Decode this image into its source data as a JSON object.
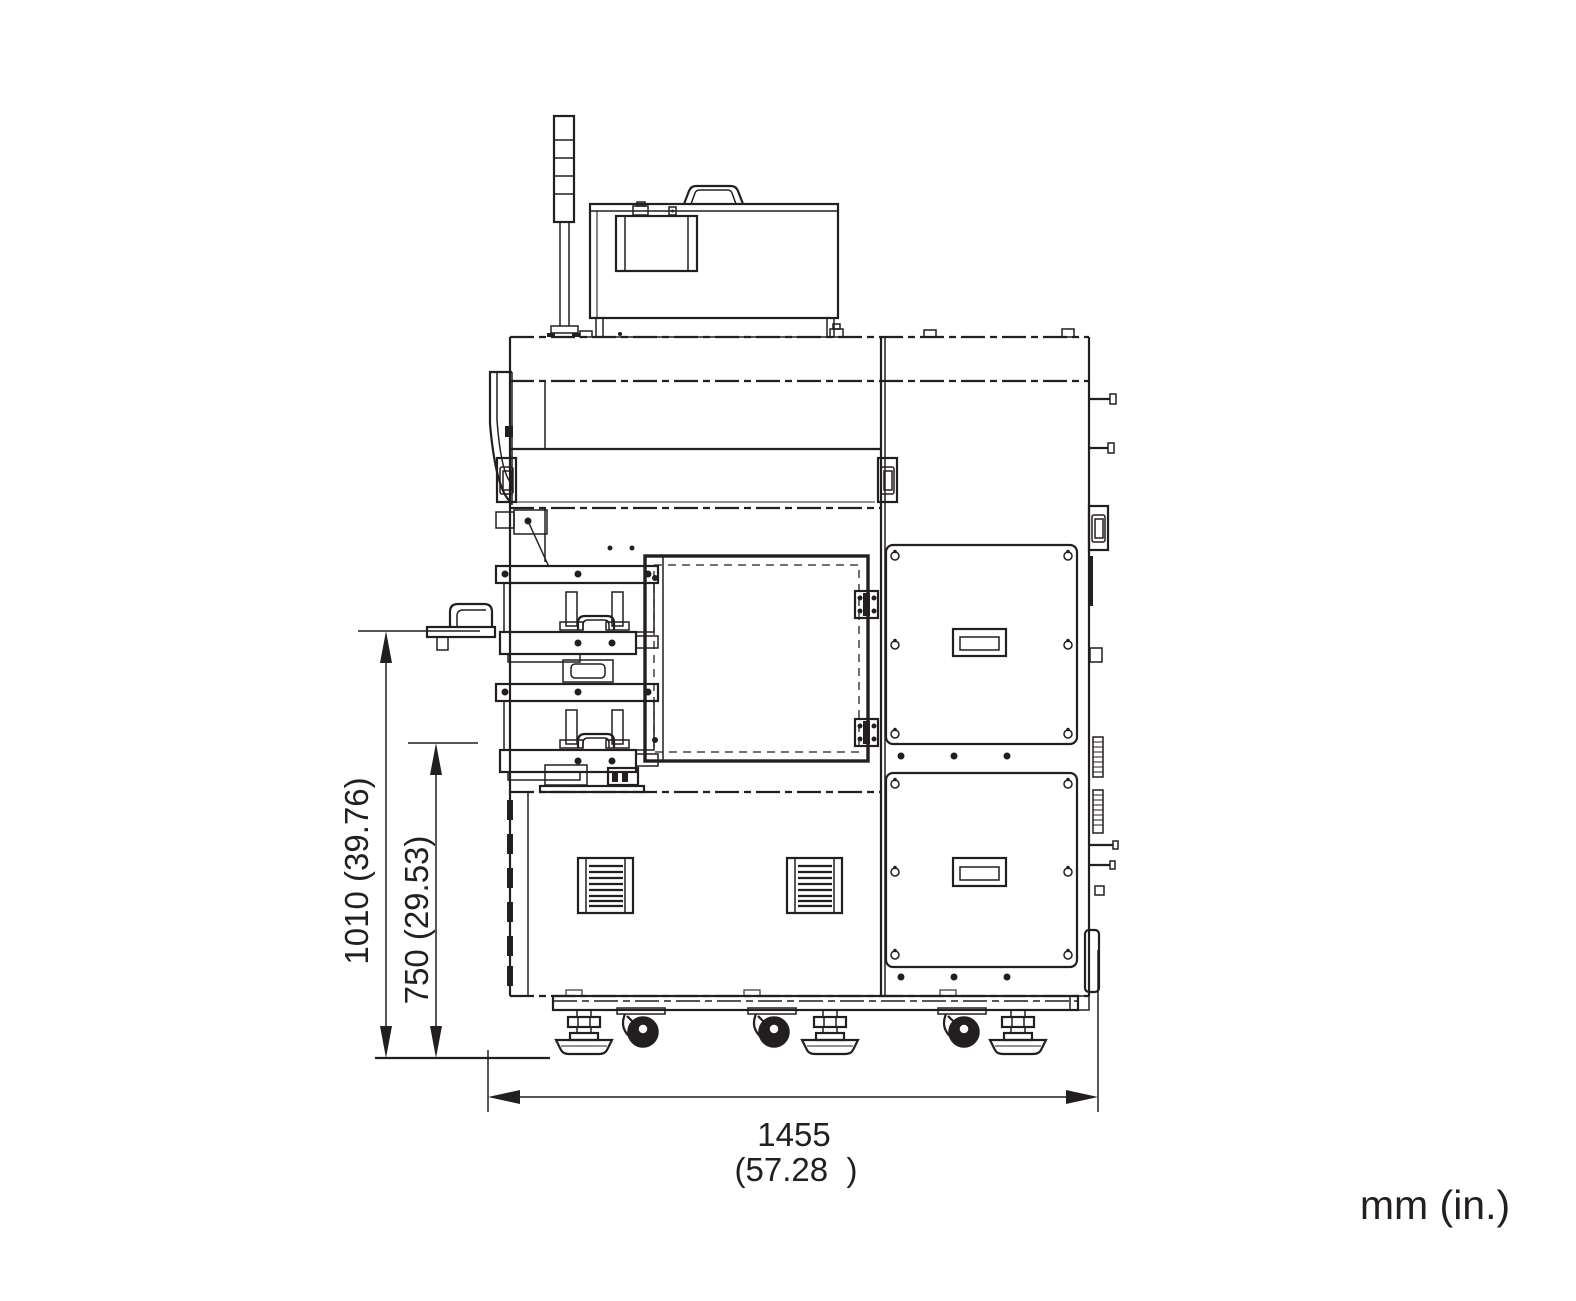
{
  "drawing": {
    "title": "machine-front-view-dimensional-drawing",
    "units_note": "mm (in.)",
    "dimensions": {
      "overall_height": "1010 (39.76)",
      "table_height": "750 (29.53)",
      "overall_width_value": "1455",
      "overall_width_inches": "(57.28  )"
    },
    "colors": {
      "line": "#231f20",
      "background": "#ffffff"
    }
  }
}
